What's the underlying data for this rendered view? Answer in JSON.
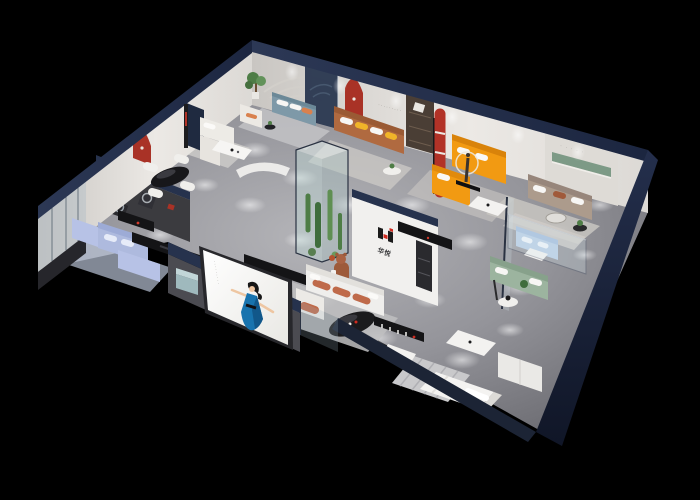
{
  "scene": {
    "title": "Isometric cutaway 3D render of a furniture showroom",
    "type": "3d-floorplan-render",
    "background": "#000000"
  },
  "brand": {
    "logo_mark": "H-block mark (black bars with red squares)",
    "logo_characters": "华悦"
  },
  "texts": {
    "wall_text_small": "·········",
    "plaque_text": "· · · · ·",
    "screen_side_text": "·········"
  },
  "colors": {
    "bg": "#000000",
    "navy": "#26324d",
    "navyDark": "#1a2338",
    "wall": "#e7e4e0",
    "wallShade": "#c7c4c0",
    "charcoal": "#3b3b3f",
    "floor": "#97979b",
    "red": "#a93226",
    "logoRed": "#cf2b20",
    "orange": "#f29a12",
    "caramel": "#b06a40",
    "blueGray": "#7e99a8",
    "periwinkle": "#aebade",
    "taupe": "#ac9b8c",
    "sage": "#9cb49f",
    "terracotta": "#bf6a4a",
    "yellow": "#f0b429",
    "teal": "#9fb9bd",
    "plant": "#4e7d46",
    "glass": "#bcd3da",
    "dress": "#1873ae",
    "skin": "#eec6a2",
    "screen": "#f7f6f4"
  },
  "rooms": [
    {
      "id": "dining-display",
      "label": "dining display",
      "items": [
        "black oval dining table",
        "white dining chairs",
        "red arch niche",
        "charcoal media wall",
        "round wall art"
      ]
    },
    {
      "id": "cream-living-display",
      "label": "cream sofa display",
      "items": [
        "cream sectional sofa",
        "white coffee table",
        "cream armchair",
        "striped floor lamp",
        "curved white partition"
      ]
    },
    {
      "id": "bluegray-living-display",
      "label": "blue-gray sofa display",
      "items": [
        "blue-gray sofa",
        "white armchair",
        "potted tree",
        "black side table"
      ]
    },
    {
      "id": "caramel-living-display",
      "label": "caramel leather sofa display",
      "items": [
        "caramel sofa",
        "yellow pillows",
        "round white table"
      ]
    },
    {
      "id": "orange-living-display",
      "label": "orange sectional display",
      "items": [
        "orange sectional sofa",
        "white coffee table",
        "figure sculpture with halo light",
        "walnut shelf panel",
        "red striped column"
      ]
    },
    {
      "id": "taupe-living-display",
      "label": "taupe sofa display",
      "items": [
        "taupe sofa",
        "glass coffee table",
        "green recessed shelf",
        "striped rug"
      ]
    },
    {
      "id": "green-showcase",
      "label": "sage sofa and glass showcase",
      "items": [
        "sage green sofa",
        "glass display box",
        "powder blue sofa",
        "round side table"
      ]
    },
    {
      "id": "brand-lounge",
      "label": "brand lounge",
      "items": [
        "logo feature wall",
        "white sofa with terracotta cushions",
        "black oval coffee table",
        "teddy bear sculpture",
        "display rack",
        "white ottoman",
        "terracotta armchair"
      ]
    },
    {
      "id": "bedroom-display",
      "label": "bedroom display",
      "items": [
        "white bed",
        "striped rug",
        "white table",
        "white cabinet"
      ]
    },
    {
      "id": "periwinkle-living-display",
      "label": "periwinkle sofa display",
      "items": [
        "periwinkle sectional",
        "black consoles",
        "glass storefront"
      ]
    },
    {
      "id": "atrium",
      "label": "glass plant atrium",
      "items": [
        "cacti",
        "glass enclosure"
      ]
    },
    {
      "id": "facade",
      "label": "front facade",
      "items": [
        "advertising screen with woman in blue dress",
        "teal cube stool",
        "navy perimeter walls"
      ]
    }
  ]
}
